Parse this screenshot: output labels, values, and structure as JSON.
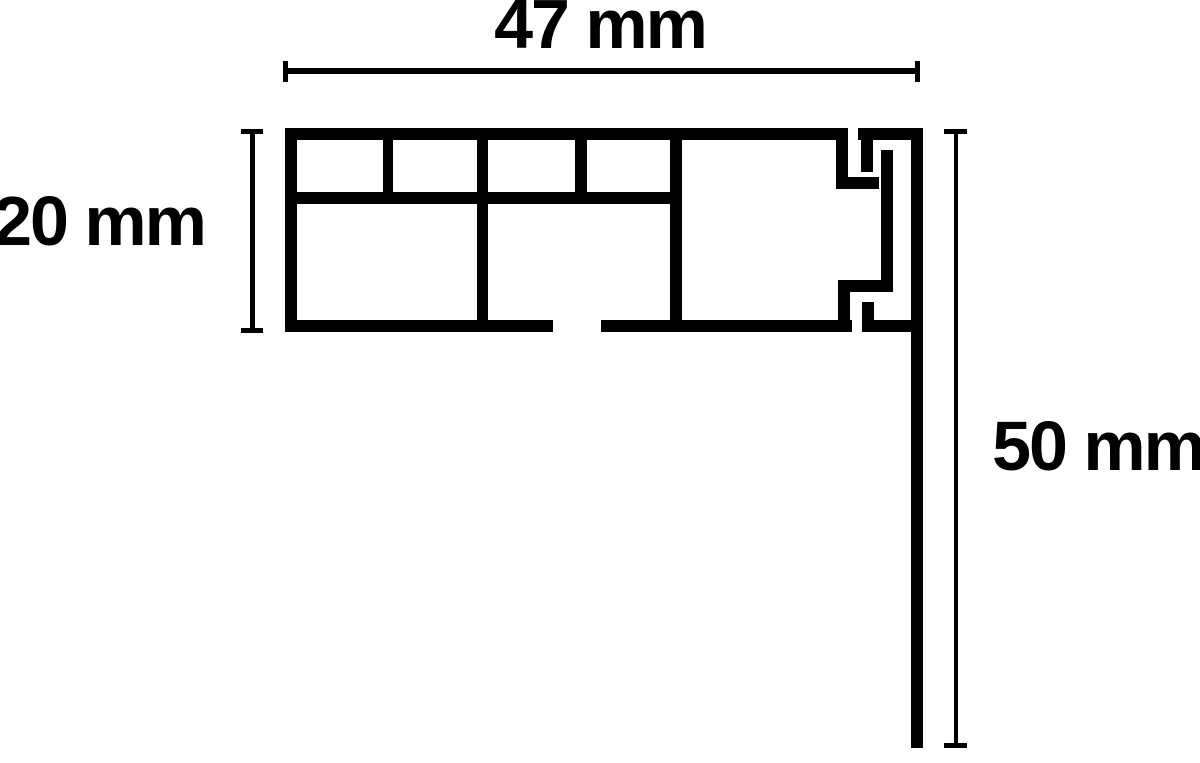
{
  "diagram": {
    "type": "technical-cross-section",
    "labels": {
      "width": "47 mm",
      "height": "20 mm",
      "drop": "50 mm"
    },
    "colors": {
      "ink": "#000000",
      "background": "#ffffff"
    }
  }
}
